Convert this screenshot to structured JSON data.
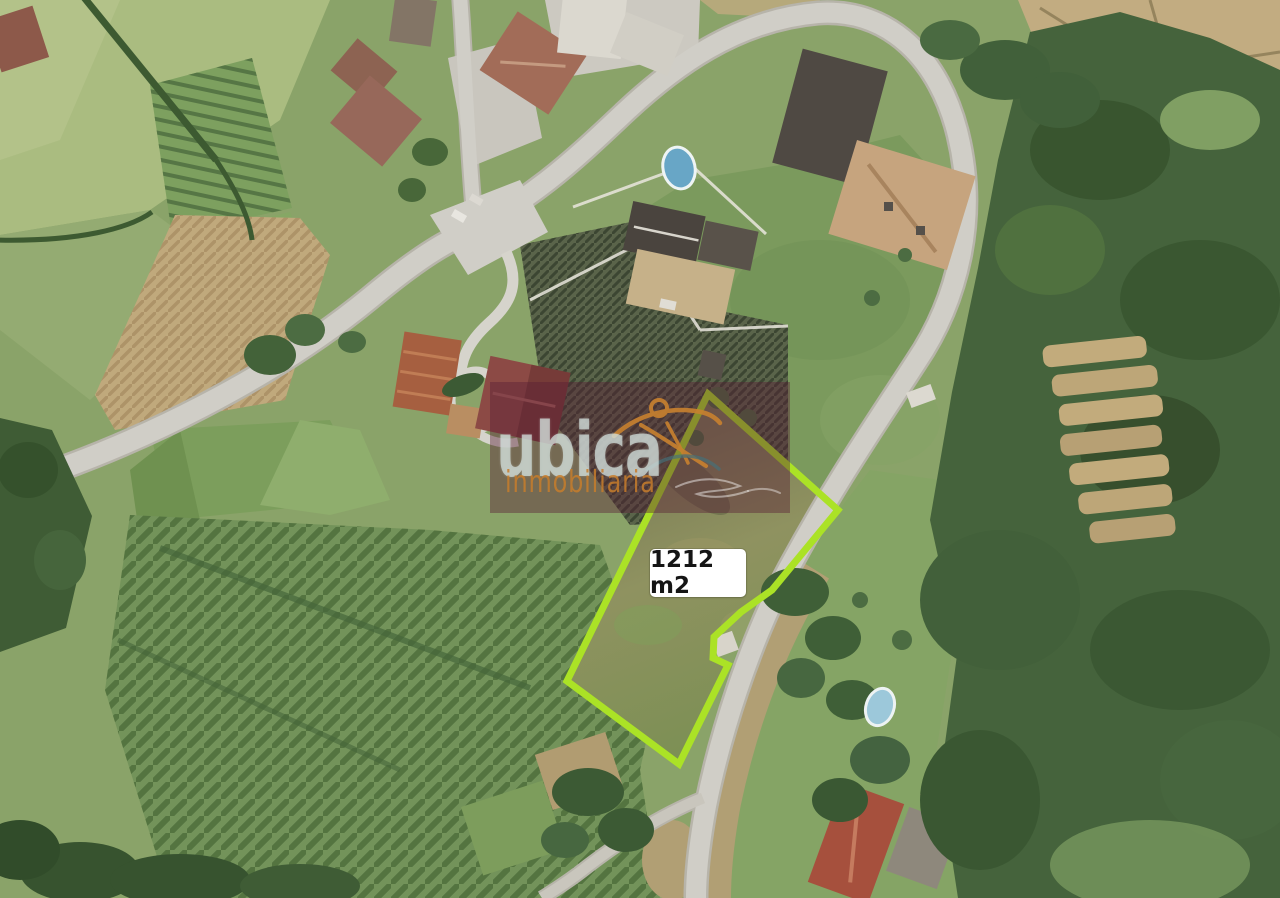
{
  "parcel": {
    "area_label": "1212 m2",
    "outline_color": "#abe226",
    "label_background": "#ffffff",
    "label_text_color": "#151515"
  },
  "watermark": {
    "brand": "ubica",
    "tagline": "inmobiliaria",
    "brand_color": "rgba(209,222,218,0.74)",
    "tagline_color": "rgba(199,125,44,0.85)",
    "logo_orange": "#c8812f",
    "logo_teal": "#45707a",
    "overlay_color": "#581c34"
  }
}
